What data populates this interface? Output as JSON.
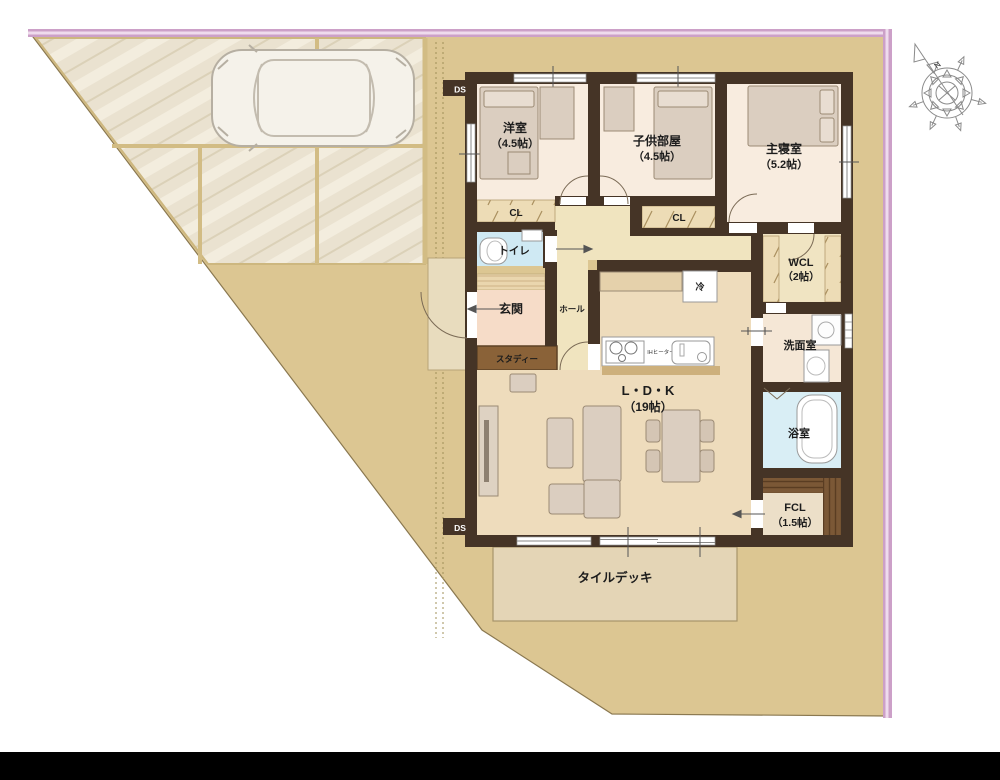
{
  "compass": {
    "north": "N"
  },
  "labels": {
    "ds": "DS",
    "yoshitsu_name": "洋室",
    "yoshitsu_size": "（4.5帖）",
    "kodomobeya_name": "子供部屋",
    "kodomobeya_size": "（4.5帖）",
    "shushinshitsu_name": "主寝室",
    "shushinshitsu_size": "（5.2帖）",
    "cl": "CL",
    "toilet": "トイレ",
    "wcl_name": "WCL",
    "wcl_size": "（2帖）",
    "genkan": "玄関",
    "hall": "ホール",
    "study": "スタディー",
    "ldk_name": "L・D・K",
    "ldk_size": "（19帖）",
    "senmenshitsu": "洗面室",
    "yokushitsu": "浴室",
    "fcl_name": "FCL",
    "fcl_size": "（1.5帖）",
    "tiledeck": "タイルデッキ",
    "fridge": "冷",
    "ih_heater": "IHヒーター"
  },
  "colors": {
    "lot": "#dcc692",
    "parking": "#eae2d0",
    "boundary_pink": "#cca0c8",
    "wall": "#453426",
    "bedroom_floor": "#f8ecdf",
    "hall_floor": "#f0e4bf",
    "ldk_floor": "#eedcbc",
    "genkan_floor": "#f6dcc8",
    "wet_blue": "#cfe9f3",
    "deck": "#e4d5b6",
    "wood_dark": "#7b5836",
    "bottom_band": "#000000"
  }
}
